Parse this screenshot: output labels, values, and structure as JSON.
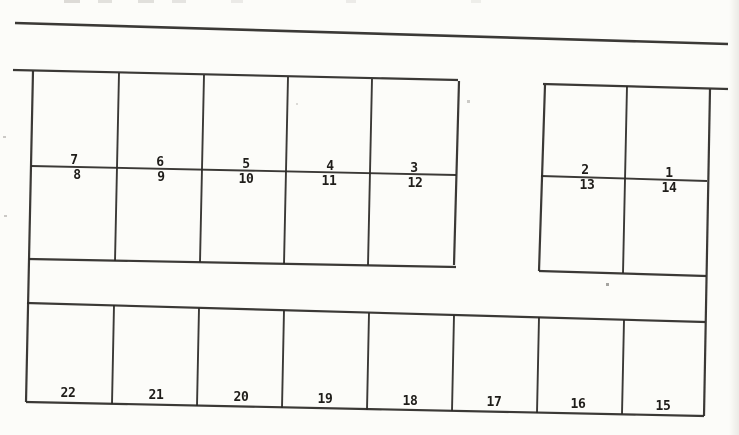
{
  "diagram": {
    "type": "parking-lot-plan",
    "background": "#fcfcf9",
    "line_color": "#2c2a27",
    "label_color": "#1f1d1a",
    "label_font_size": 13,
    "total_spaces": 22,
    "space_groups": {
      "upper_left_block_top_row": [
        "7",
        "6",
        "5",
        "4",
        "3"
      ],
      "upper_left_block_bottom_row": [
        "8",
        "9",
        "10",
        "11",
        "12"
      ],
      "upper_right_block_top_row": [
        "2",
        "1"
      ],
      "upper_right_block_bottom_row": [
        "13",
        "14"
      ],
      "bottom_row": [
        "22",
        "21",
        "20",
        "19",
        "18",
        "17",
        "16",
        "15"
      ]
    },
    "lines": [
      {
        "name": "road-edge-line",
        "x1": 15,
        "y1": 23,
        "x2": 728,
        "y2": 44,
        "w": 2.6
      },
      {
        "name": "upper-left-block-top",
        "x1": 13,
        "y1": 70,
        "x2": 458,
        "y2": 80,
        "w": 2.2
      },
      {
        "name": "left-boundary",
        "x1": 33,
        "y1": 71,
        "x2": 26,
        "y2": 402,
        "w": 2.2
      },
      {
        "name": "upper-left-block-bottom",
        "x1": 29,
        "y1": 259,
        "x2": 456,
        "y2": 267,
        "w": 2.2
      },
      {
        "name": "upper-left-block-right",
        "x1": 459,
        "y1": 81,
        "x2": 454,
        "y2": 265,
        "w": 2.2
      },
      {
        "name": "upper-left-divider-1",
        "x1": 119,
        "y1": 73,
        "x2": 115,
        "y2": 261,
        "w": 1.9
      },
      {
        "name": "upper-left-divider-2",
        "x1": 204,
        "y1": 75,
        "x2": 200,
        "y2": 262,
        "w": 1.9
      },
      {
        "name": "upper-left-divider-3",
        "x1": 288,
        "y1": 77,
        "x2": 284,
        "y2": 264,
        "w": 1.9
      },
      {
        "name": "upper-left-divider-4",
        "x1": 372,
        "y1": 79,
        "x2": 368,
        "y2": 265,
        "w": 1.9
      },
      {
        "name": "upper-left-middle-line",
        "x1": 31,
        "y1": 166,
        "x2": 456,
        "y2": 175,
        "w": 1.9
      },
      {
        "name": "upper-right-block-top",
        "x1": 543,
        "y1": 84,
        "x2": 728,
        "y2": 89,
        "w": 2.2
      },
      {
        "name": "upper-right-block-left",
        "x1": 545,
        "y1": 85,
        "x2": 539,
        "y2": 271,
        "w": 2.2
      },
      {
        "name": "right-boundary",
        "x1": 710,
        "y1": 89,
        "x2": 704,
        "y2": 416,
        "w": 2.2
      },
      {
        "name": "upper-right-block-bottom",
        "x1": 539,
        "y1": 271,
        "x2": 706,
        "y2": 276,
        "w": 2.2
      },
      {
        "name": "upper-right-divider",
        "x1": 627,
        "y1": 86,
        "x2": 623,
        "y2": 273,
        "w": 1.9
      },
      {
        "name": "upper-right-middle-line",
        "x1": 541,
        "y1": 176,
        "x2": 707,
        "y2": 181,
        "w": 1.9
      },
      {
        "name": "bottom-row-top",
        "x1": 27,
        "y1": 303,
        "x2": 705,
        "y2": 322,
        "w": 2.2
      },
      {
        "name": "bottom-row-bottom",
        "x1": 26,
        "y1": 402,
        "x2": 704,
        "y2": 416,
        "w": 2.2
      },
      {
        "name": "bottom-divider-1",
        "x1": 114,
        "y1": 305,
        "x2": 112,
        "y2": 404,
        "w": 1.9
      },
      {
        "name": "bottom-divider-2",
        "x1": 199,
        "y1": 308,
        "x2": 197,
        "y2": 406,
        "w": 1.9
      },
      {
        "name": "bottom-divider-3",
        "x1": 284,
        "y1": 310,
        "x2": 282,
        "y2": 408,
        "w": 1.9
      },
      {
        "name": "bottom-divider-4",
        "x1": 369,
        "y1": 313,
        "x2": 367,
        "y2": 410,
        "w": 1.9
      },
      {
        "name": "bottom-divider-5",
        "x1": 454,
        "y1": 315,
        "x2": 452,
        "y2": 411,
        "w": 1.9
      },
      {
        "name": "bottom-divider-6",
        "x1": 539,
        "y1": 317,
        "x2": 537,
        "y2": 413,
        "w": 1.9
      },
      {
        "name": "bottom-divider-7",
        "x1": 624,
        "y1": 320,
        "x2": 622,
        "y2": 414,
        "w": 1.9
      }
    ],
    "labels": [
      {
        "text": "7",
        "x": 74,
        "y": 164
      },
      {
        "text": "6",
        "x": 160,
        "y": 166
      },
      {
        "text": "5",
        "x": 246,
        "y": 168
      },
      {
        "text": "4",
        "x": 330,
        "y": 170
      },
      {
        "text": "3",
        "x": 414,
        "y": 172
      },
      {
        "text": "8",
        "x": 77,
        "y": 179
      },
      {
        "text": "9",
        "x": 161,
        "y": 181
      },
      {
        "text": "10",
        "x": 246,
        "y": 183
      },
      {
        "text": "11",
        "x": 329,
        "y": 185
      },
      {
        "text": "12",
        "x": 415,
        "y": 187
      },
      {
        "text": "2",
        "x": 585,
        "y": 174
      },
      {
        "text": "1",
        "x": 669,
        "y": 177
      },
      {
        "text": "13",
        "x": 587,
        "y": 189
      },
      {
        "text": "14",
        "x": 669,
        "y": 192
      },
      {
        "text": "22",
        "x": 68,
        "y": 397
      },
      {
        "text": "21",
        "x": 156,
        "y": 399
      },
      {
        "text": "20",
        "x": 241,
        "y": 401
      },
      {
        "text": "19",
        "x": 325,
        "y": 403
      },
      {
        "text": "18",
        "x": 410,
        "y": 405
      },
      {
        "text": "17",
        "x": 494,
        "y": 406
      },
      {
        "text": "16",
        "x": 578,
        "y": 408
      },
      {
        "text": "15",
        "x": 663,
        "y": 410
      }
    ],
    "artifacts": [
      {
        "kind": "top-edge-smudge",
        "x": 64,
        "y": 0,
        "w": 16,
        "h": 3,
        "color": "#c2c0bc",
        "opacity": 0.55
      },
      {
        "kind": "top-edge-smudge",
        "x": 98,
        "y": 0,
        "w": 14,
        "h": 3,
        "color": "#c8c6c2",
        "opacity": 0.5
      },
      {
        "kind": "top-edge-smudge",
        "x": 138,
        "y": 0,
        "w": 16,
        "h": 3,
        "color": "#c5c3bf",
        "opacity": 0.5
      },
      {
        "kind": "top-edge-smudge",
        "x": 172,
        "y": 0,
        "w": 14,
        "h": 3,
        "color": "#cac8c4",
        "opacity": 0.45
      },
      {
        "kind": "top-edge-smudge",
        "x": 231,
        "y": 0,
        "w": 12,
        "h": 3,
        "color": "#d2d0cc",
        "opacity": 0.4
      },
      {
        "kind": "top-edge-smudge",
        "x": 346,
        "y": 0,
        "w": 10,
        "h": 3,
        "color": "#d5d3cf",
        "opacity": 0.4
      },
      {
        "kind": "top-edge-smudge",
        "x": 471,
        "y": 0,
        "w": 10,
        "h": 3,
        "color": "#d5d3cf",
        "opacity": 0.35
      },
      {
        "kind": "speck",
        "x": 467,
        "y": 100,
        "w": 3,
        "h": 3,
        "color": "#b8b6b2",
        "opacity": 0.7
      },
      {
        "kind": "speck",
        "x": 296,
        "y": 103,
        "w": 2,
        "h": 2,
        "color": "#c0beba",
        "opacity": 0.55
      },
      {
        "kind": "speck",
        "x": 606,
        "y": 283,
        "w": 3,
        "h": 3,
        "color": "#8f8d89",
        "opacity": 0.8
      },
      {
        "kind": "speck",
        "x": 3,
        "y": 136,
        "w": 3,
        "h": 2,
        "color": "#b0aeaa",
        "opacity": 0.65
      },
      {
        "kind": "speck",
        "x": 4,
        "y": 215,
        "w": 3,
        "h": 2,
        "color": "#b0aeaa",
        "opacity": 0.65
      }
    ]
  }
}
